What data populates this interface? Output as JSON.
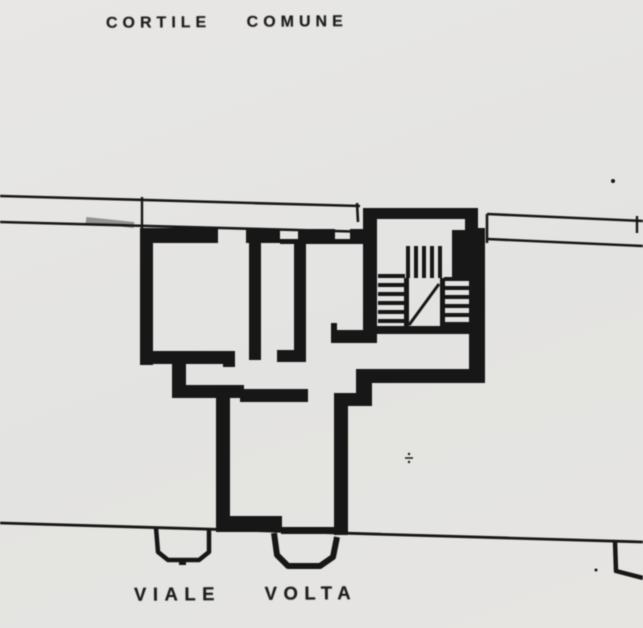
{
  "meta": {
    "paper_color": "#e5e4e2",
    "ink_color": "#1c1c1c"
  },
  "labels": {
    "courtyard": "CORTILE COMUNE",
    "street": "VIALE VOLTA"
  },
  "plan": {
    "ink": "#1c1c1c",
    "paper": "#e5e4e2",
    "shapes": [
      {
        "t": "line",
        "x1": 0,
        "y1": 196,
        "x2": 360,
        "y2": 206,
        "w": 2.6,
        "n": "courtyard-boundary-upper-left"
      },
      {
        "t": "line",
        "x1": 357,
        "y1": 203,
        "x2": 358,
        "y2": 222,
        "w": 2.6,
        "n": "boundary-tick-left"
      },
      {
        "t": "line",
        "x1": 142,
        "y1": 197,
        "x2": 142,
        "y2": 229,
        "w": 2.4,
        "n": "boundary-connector-left"
      },
      {
        "t": "line",
        "x1": 0,
        "y1": 222,
        "x2": 372,
        "y2": 232,
        "w": 2.6,
        "n": "courtyard-boundary-lower-left"
      },
      {
        "t": "line",
        "x1": 86,
        "y1": 220,
        "x2": 134,
        "y2": 225,
        "w": 6,
        "o": 0.4,
        "n": "line-smudge"
      },
      {
        "t": "line",
        "x1": 487,
        "y1": 214,
        "x2": 643,
        "y2": 221,
        "w": 2.6,
        "n": "courtyard-boundary-upper-right"
      },
      {
        "t": "line",
        "x1": 637,
        "y1": 216,
        "x2": 637,
        "y2": 233,
        "w": 2.4,
        "n": "boundary-tick-right"
      },
      {
        "t": "line",
        "x1": 487,
        "y1": 214,
        "x2": 487,
        "y2": 243,
        "w": 2.6,
        "n": "boundary-connector-right"
      },
      {
        "t": "line",
        "x1": 487,
        "y1": 239,
        "x2": 643,
        "y2": 246,
        "w": 2.6,
        "n": "courtyard-boundary-lower-right"
      },
      {
        "t": "line",
        "x1": 0,
        "y1": 523,
        "x2": 643,
        "y2": 542,
        "w": 2.8,
        "n": "street-boundary-line"
      },
      {
        "t": "rect",
        "x": 140,
        "y": 228,
        "w": 78,
        "h": 15,
        "n": "top-wall"
      },
      {
        "t": "rect",
        "x": 246,
        "y": 229,
        "w": 34,
        "h": 14,
        "n": "top-wall"
      },
      {
        "t": "rect",
        "x": 280,
        "y": 239,
        "w": 18,
        "h": 5,
        "n": "window-sill"
      },
      {
        "t": "rect",
        "x": 298,
        "y": 229,
        "w": 37,
        "h": 15,
        "n": "top-wall"
      },
      {
        "t": "rect",
        "x": 335,
        "y": 239,
        "w": 15,
        "h": 5,
        "n": "window-sill"
      },
      {
        "t": "rect",
        "x": 350,
        "y": 229,
        "w": 13,
        "h": 15,
        "n": "top-wall"
      },
      {
        "t": "rect",
        "x": 140,
        "y": 228,
        "w": 13,
        "h": 137,
        "n": "left-exterior-wall"
      },
      {
        "t": "rect",
        "x": 140,
        "y": 351,
        "w": 95,
        "h": 13,
        "n": "room-bottom-wall"
      },
      {
        "t": "rect",
        "x": 223,
        "y": 351,
        "w": 12,
        "h": 16,
        "n": "wall-stub"
      },
      {
        "t": "rect",
        "x": 172,
        "y": 360,
        "w": 14,
        "h": 30,
        "n": "step-wall"
      },
      {
        "t": "rect",
        "x": 172,
        "y": 385,
        "w": 72,
        "h": 13,
        "n": "mid-wall"
      },
      {
        "t": "rect",
        "x": 240,
        "y": 389,
        "w": 68,
        "h": 13,
        "n": "mid-wall"
      },
      {
        "t": "rect",
        "x": 216,
        "y": 387,
        "w": 14,
        "h": 143,
        "n": "wing-left-wall"
      },
      {
        "t": "rect",
        "x": 216,
        "y": 516,
        "w": 66,
        "h": 16,
        "n": "wing-bottom-wall"
      },
      {
        "t": "rect",
        "x": 281,
        "y": 527,
        "w": 53,
        "h": 7,
        "n": "wing-bottom-sill"
      },
      {
        "t": "rect",
        "x": 334,
        "y": 398,
        "w": 14,
        "h": 137,
        "n": "wing-right-wall"
      },
      {
        "t": "rect",
        "x": 334,
        "y": 393,
        "w": 38,
        "h": 13,
        "n": "corner-wall"
      },
      {
        "t": "rect",
        "x": 356,
        "y": 370,
        "w": 16,
        "h": 35,
        "n": "corner-wall"
      },
      {
        "t": "rect",
        "x": 356,
        "y": 369,
        "w": 114,
        "h": 14,
        "n": "bottom-wall-right-section"
      },
      {
        "t": "rect",
        "x": 465,
        "y": 208,
        "w": 13,
        "h": 50,
        "n": "stair-bay-right-wall"
      },
      {
        "t": "rect",
        "x": 469,
        "y": 228,
        "w": 16,
        "h": 155,
        "n": "right-exterior-wall"
      },
      {
        "t": "rect",
        "x": 368,
        "y": 208,
        "w": 109,
        "h": 11,
        "n": "stair-bay-top-wall"
      },
      {
        "t": "rect",
        "x": 363,
        "y": 208,
        "w": 14,
        "h": 135,
        "n": "stair-left-wall"
      },
      {
        "t": "rect",
        "x": 331,
        "y": 330,
        "w": 41,
        "h": 13,
        "n": "stair-bottom-wall"
      },
      {
        "t": "rect",
        "x": 331,
        "y": 323,
        "w": 6,
        "h": 10,
        "n": "wall-stub"
      },
      {
        "t": "rect",
        "x": 249,
        "y": 243,
        "w": 12,
        "h": 117,
        "n": "partition-wall-a"
      },
      {
        "t": "rect",
        "x": 294,
        "y": 243,
        "w": 12,
        "h": 110,
        "n": "partition-wall-b"
      },
      {
        "t": "rect",
        "x": 277,
        "y": 350,
        "w": 29,
        "h": 12,
        "n": "partition-foot"
      },
      {
        "t": "rect",
        "x": 452,
        "y": 230,
        "w": 25,
        "h": 50,
        "n": "stair-corner-block"
      },
      {
        "t": "rect",
        "x": 372,
        "y": 326,
        "w": 98,
        "h": 8,
        "n": "stair-base-line"
      },
      {
        "t": "rect",
        "x": 406,
        "y": 246,
        "w": 4,
        "h": 32,
        "n": "stair-baluster"
      },
      {
        "t": "rect",
        "x": 414,
        "y": 246,
        "w": 4,
        "h": 32,
        "n": "stair-baluster"
      },
      {
        "t": "rect",
        "x": 422,
        "y": 246,
        "w": 4,
        "h": 32,
        "n": "stair-baluster"
      },
      {
        "t": "rect",
        "x": 430,
        "y": 246,
        "w": 4,
        "h": 32,
        "n": "stair-baluster"
      },
      {
        "t": "rect",
        "x": 438,
        "y": 246,
        "w": 4,
        "h": 32,
        "n": "stair-baluster"
      },
      {
        "t": "rect",
        "x": 404,
        "y": 278,
        "w": 5,
        "h": 50,
        "n": "stair-landing-edge"
      },
      {
        "t": "rect",
        "x": 440,
        "y": 278,
        "w": 5,
        "h": 50,
        "n": "stair-landing-edge"
      },
      {
        "t": "rect",
        "x": 378,
        "y": 274,
        "w": 27,
        "h": 4,
        "n": "stair-tread"
      },
      {
        "t": "rect",
        "x": 378,
        "y": 283,
        "w": 27,
        "h": 4,
        "n": "stair-tread"
      },
      {
        "t": "rect",
        "x": 378,
        "y": 292,
        "w": 27,
        "h": 4,
        "n": "stair-tread"
      },
      {
        "t": "rect",
        "x": 378,
        "y": 301,
        "w": 27,
        "h": 4,
        "n": "stair-tread"
      },
      {
        "t": "rect",
        "x": 378,
        "y": 310,
        "w": 27,
        "h": 4,
        "n": "stair-tread"
      },
      {
        "t": "rect",
        "x": 378,
        "y": 319,
        "w": 27,
        "h": 4,
        "n": "stair-tread"
      },
      {
        "t": "rect",
        "x": 444,
        "y": 277,
        "w": 25,
        "h": 4,
        "n": "stair-tread"
      },
      {
        "t": "rect",
        "x": 444,
        "y": 286,
        "w": 25,
        "h": 4,
        "n": "stair-tread"
      },
      {
        "t": "rect",
        "x": 444,
        "y": 295,
        "w": 25,
        "h": 4,
        "n": "stair-tread"
      },
      {
        "t": "rect",
        "x": 444,
        "y": 304,
        "w": 25,
        "h": 4,
        "n": "stair-tread"
      },
      {
        "t": "rect",
        "x": 444,
        "y": 313,
        "w": 25,
        "h": 4,
        "n": "stair-tread"
      },
      {
        "t": "rect",
        "x": 444,
        "y": 322,
        "w": 25,
        "h": 4,
        "n": "stair-tread"
      },
      {
        "t": "line",
        "x1": 409,
        "y1": 325,
        "x2": 439,
        "y2": 284,
        "w": 3,
        "n": "stair-direction-line"
      },
      {
        "t": "poly",
        "pts": "156,528 158,552 168,560 199,560 209,552 209,529",
        "w": 4.5,
        "n": "entrance-bay-left"
      },
      {
        "t": "rect",
        "x": 179,
        "y": 558,
        "w": 7,
        "h": 7,
        "n": "bay-mark"
      },
      {
        "t": "poly",
        "pts": "274,533 277,555 288,566 320,566 333,557 337,537",
        "w": 6,
        "n": "entrance-bay-center"
      },
      {
        "t": "poly",
        "pts": "615,541 616,571 643,578",
        "w": 4.5,
        "n": "entrance-bay-right-partial"
      },
      {
        "t": "dot",
        "x": 613,
        "y": 181,
        "r": 2,
        "n": "scan-speck"
      },
      {
        "t": "dot",
        "x": 596,
        "y": 570,
        "r": 1.5,
        "n": "scan-speck"
      },
      {
        "t": "line",
        "x1": 405,
        "y1": 458,
        "x2": 413,
        "y2": 458,
        "w": 1.5,
        "n": "scan-mark"
      },
      {
        "t": "dot",
        "x": 409,
        "y": 454,
        "r": 1.2,
        "n": "scan-mark"
      },
      {
        "t": "dot",
        "x": 409,
        "y": 462,
        "r": 1.2,
        "n": "scan-mark"
      }
    ]
  }
}
